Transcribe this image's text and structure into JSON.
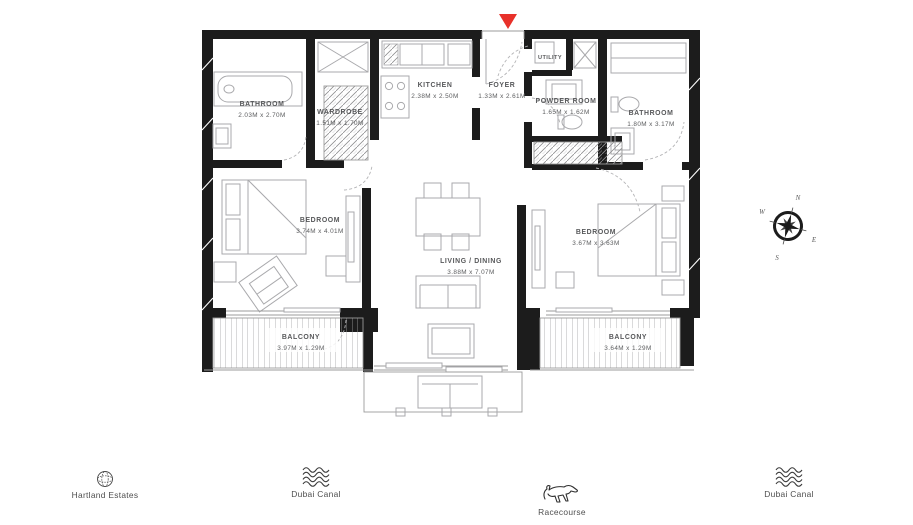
{
  "floorplan": {
    "rooms": {
      "bathroom1": {
        "name": "BATHROOM",
        "dims": "2.03M x 2.70M"
      },
      "wardrobe": {
        "name": "WARDROBE",
        "dims": "1.51M x 1.70M"
      },
      "kitchen": {
        "name": "KITCHEN",
        "dims": "2.38M x 2.50M"
      },
      "foyer": {
        "name": "FOYER",
        "dims": "1.33M x 2.61M"
      },
      "utility": {
        "name": "UTILITY"
      },
      "powder_room": {
        "name": "POWDER ROOM",
        "dims": "1.65M x 1.62M"
      },
      "bathroom2": {
        "name": "BATHROOM",
        "dims": "1.80M x 3.17M"
      },
      "bedroom1": {
        "name": "BEDROOM",
        "dims": "3.74M x 4.01M"
      },
      "living_dining": {
        "name": "LIVING / DINING",
        "dims": "3.88M x 7.07M"
      },
      "bedroom2": {
        "name": "BEDROOM",
        "dims": "3.67M x 3.63M"
      },
      "balcony1": {
        "name": "BALCONY",
        "dims": "3.97M x 1.29M"
      },
      "balcony2": {
        "name": "BALCONY",
        "dims": "3.64M x 1.29M"
      }
    },
    "compass": {
      "n": "N",
      "e": "E",
      "s": "S",
      "w": "W"
    },
    "colors": {
      "wall": "#1c1c1c",
      "entry_marker": "#e8312a",
      "label_text": "#57585a",
      "furniture": "#a9a9ac"
    }
  },
  "legend": {
    "items": [
      {
        "icon": "globe-icon",
        "label": "Hartland Estates"
      },
      {
        "icon": "waves-icon",
        "label": "Dubai Canal"
      },
      {
        "icon": "horse-icon",
        "label": "Racecourse"
      },
      {
        "icon": "waves-icon",
        "label": "Dubai Canal"
      }
    ]
  }
}
